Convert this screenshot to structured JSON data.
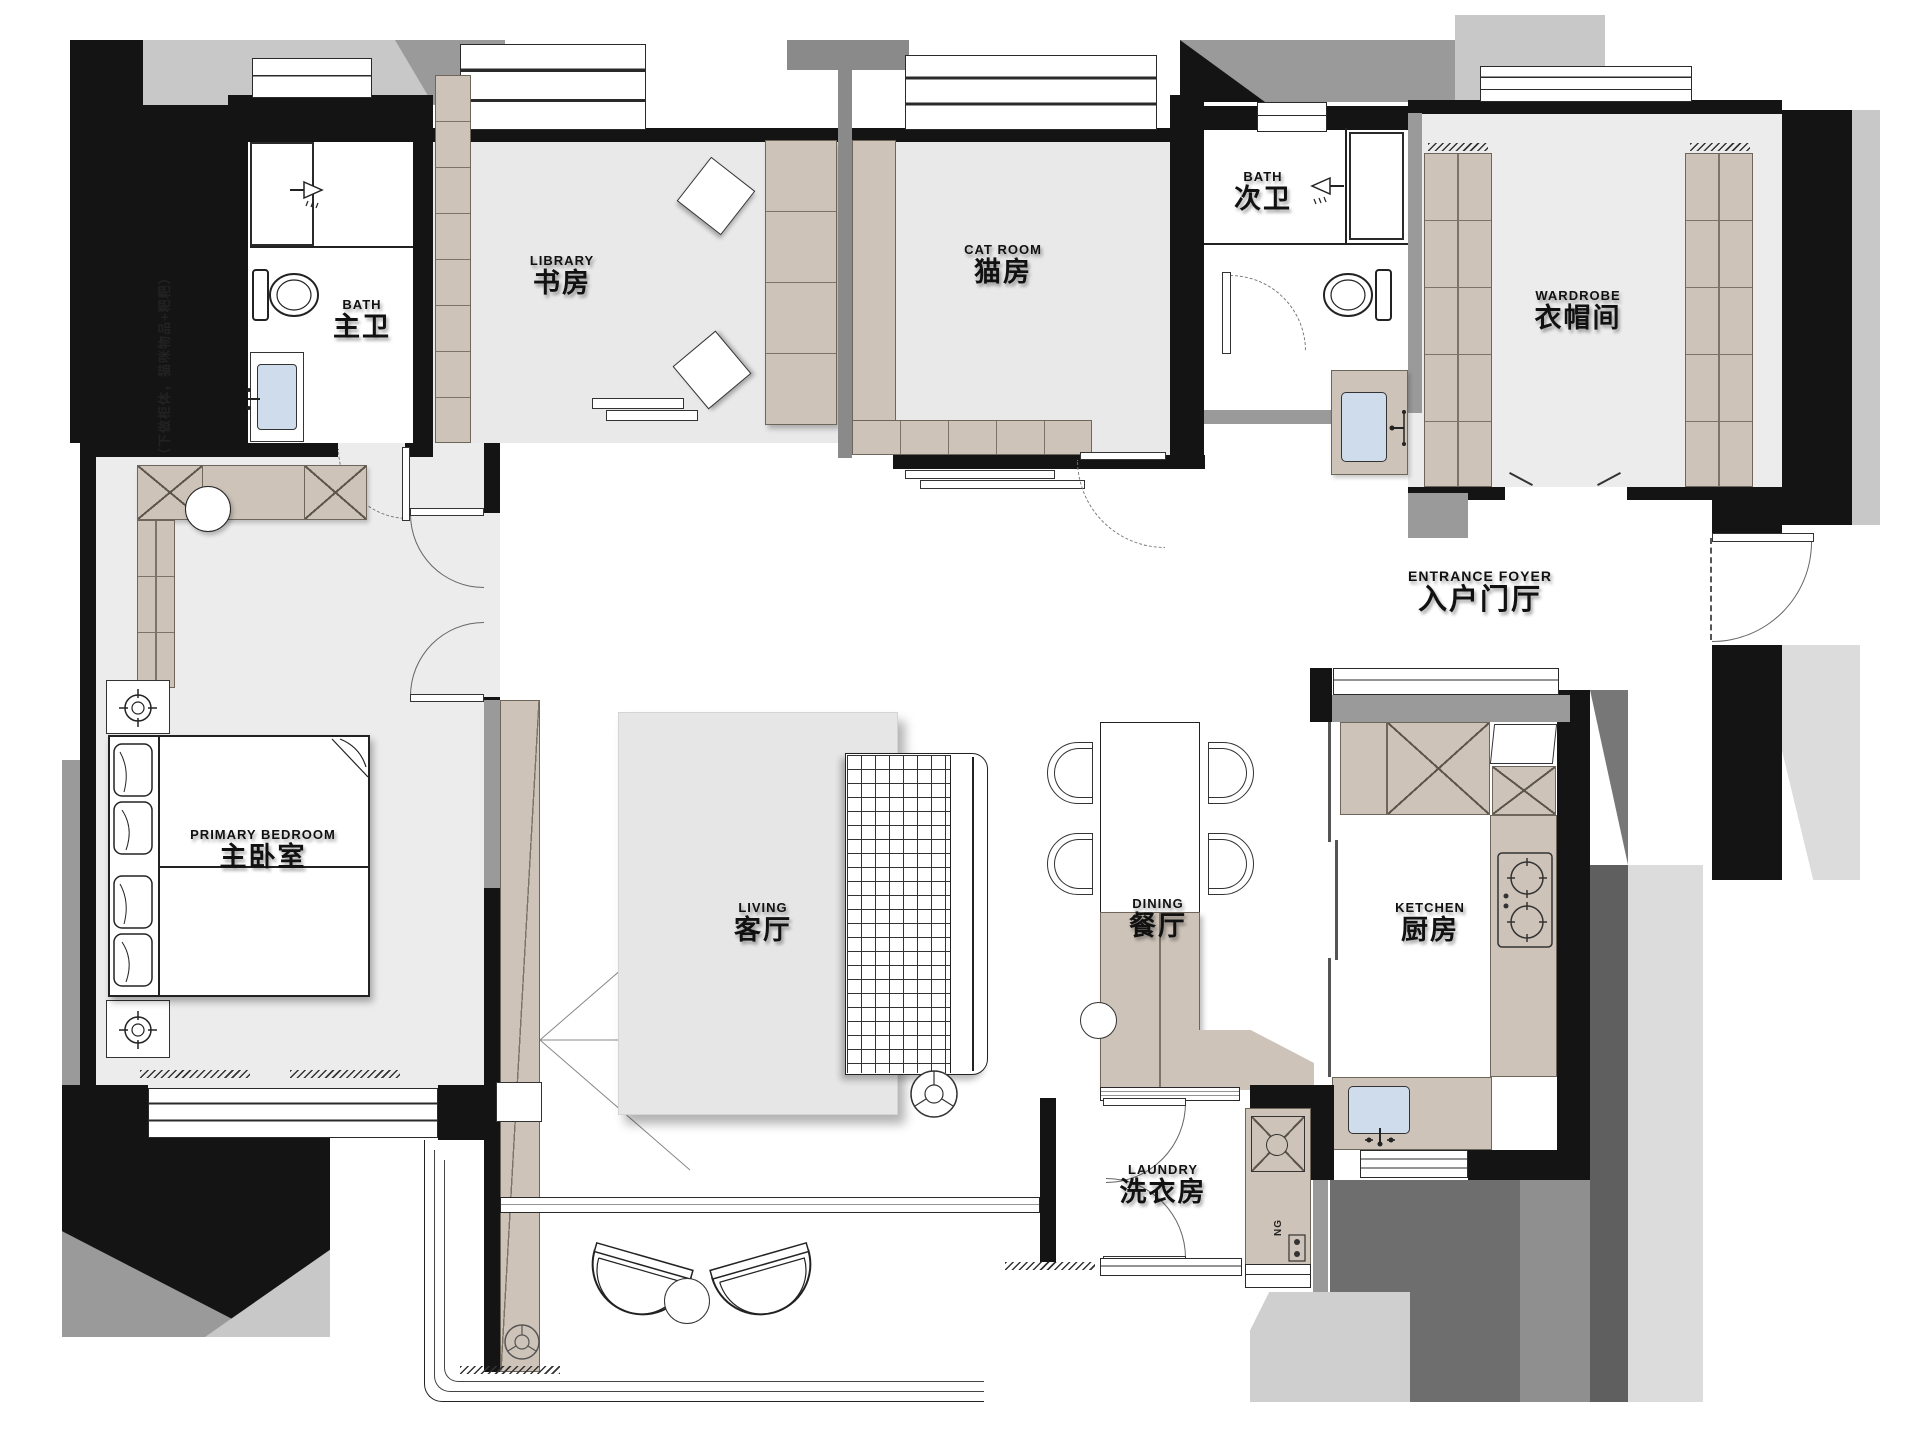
{
  "title": "apartment-floor-plan",
  "rooms": {
    "bath_master": {
      "en": "BATH",
      "zh": "主卫"
    },
    "library": {
      "en": "LIBRARY",
      "zh": "书房"
    },
    "cat_room": {
      "en": "CAT ROOM",
      "zh": "猫房"
    },
    "bath_second": {
      "en": "BATH",
      "zh": "次卫"
    },
    "wardrobe": {
      "en": "WARDROBE",
      "zh": "衣帽间"
    },
    "foyer": {
      "en": "ENTRANCE FOYER",
      "zh": "入户门厅"
    },
    "bedroom": {
      "en": "PRIMARY BEDROOM",
      "zh": "主卧室"
    },
    "living": {
      "en": "LIVING",
      "zh": "客厅"
    },
    "dining": {
      "en": "DINING",
      "zh": "餐厅"
    },
    "kitchen": {
      "en": "KETCHEN",
      "zh": "厨房"
    },
    "laundry": {
      "en": "LAUNDRY",
      "zh": "洗衣房"
    }
  },
  "notes": {
    "cat_wall": "成品猫咪跑酷区 （下做柜体，猫咪物品+粑粑）",
    "gas": "NG"
  },
  "colors": {
    "wall": "#141414",
    "gray_wall": "#9a9a9a",
    "light_gray": "#c8c8c8",
    "cabinet": "#cdc3b8",
    "floor": "#e9e9e9",
    "sink_blue": "#cfdcec"
  }
}
